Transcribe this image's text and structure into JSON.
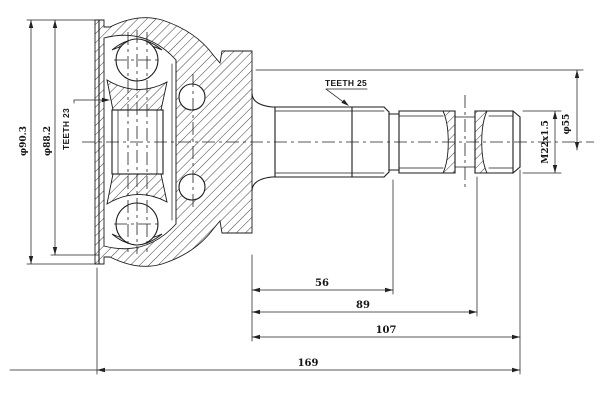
{
  "drawing": {
    "labels": {
      "dia_housing_outer": "φ90.3",
      "dia_housing_inner": "φ88.2",
      "teeth_inner": "TEETH 23",
      "teeth_shaft": "TEETH 25",
      "thread_spec": "M22x1.5",
      "dia_end": "φ55"
    },
    "dimensions": {
      "len_56": "56",
      "len_89": "89",
      "len_107": "107",
      "len_169": "169"
    }
  }
}
